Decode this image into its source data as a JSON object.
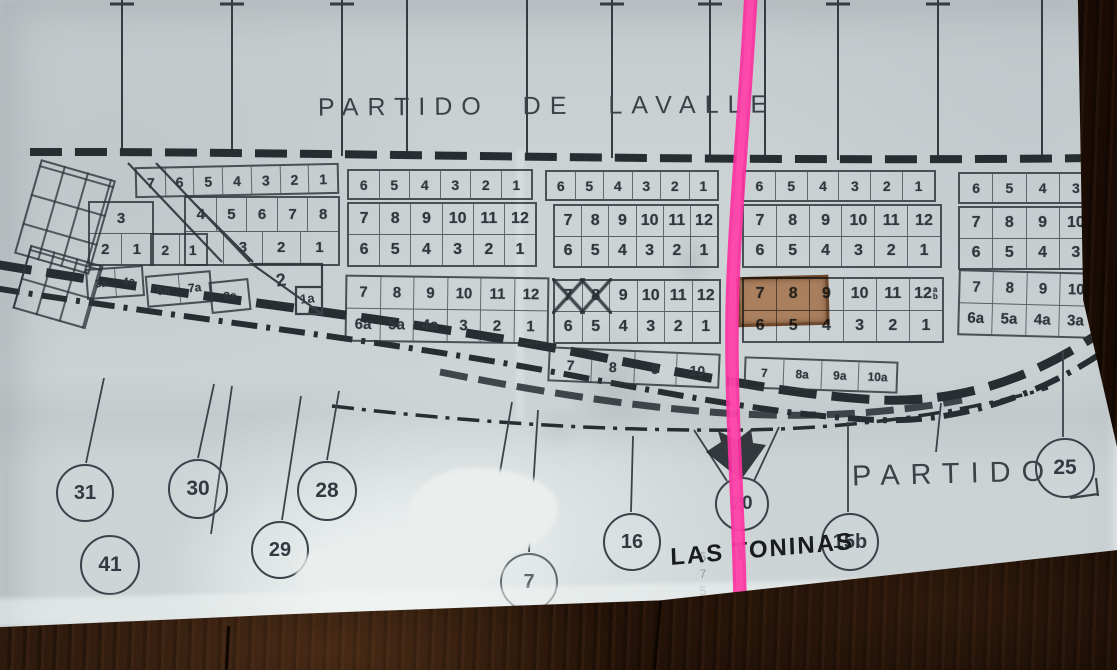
{
  "photo": {
    "title_top": "PARTIDO DE LAVALLE",
    "label_partido_right": "PARTIDO",
    "label_town": "LAS TONINAS",
    "pencil_note": "57528",
    "colors": {
      "paper": "#ccd3d5",
      "ink": "#3a4247",
      "road_ink": "#272d31",
      "pink_marker": "#fb32a0",
      "plot_highlight": "#ba5c18",
      "wood": "#291609"
    },
    "map": {
      "blocks": [
        {
          "id": "a1",
          "x": 135,
          "y": 165,
          "w": 200,
          "h": 27,
          "fs": 14,
          "rot": -1.2,
          "rows": [
            [
              "7",
              "6",
              "5",
              "4",
              "3",
              "2",
              "1"
            ]
          ]
        },
        {
          "id": "a2",
          "x": 347,
          "y": 169,
          "w": 182,
          "h": 27,
          "fs": 14,
          "rows": [
            [
              "6",
              "5",
              "4",
              "3",
              "2",
              "1"
            ]
          ]
        },
        {
          "id": "a3",
          "x": 545,
          "y": 170,
          "w": 170,
          "h": 27,
          "fs": 14,
          "rows": [
            [
              "6",
              "5",
              "4",
              "3",
              "2",
              "1"
            ]
          ]
        },
        {
          "id": "a4",
          "x": 742,
          "y": 170,
          "w": 190,
          "h": 28,
          "fs": 14,
          "rows": [
            [
              "6",
              "5",
              "4",
              "3",
              "2",
              "1"
            ]
          ]
        },
        {
          "id": "a5",
          "x": 958,
          "y": 172,
          "w": 132,
          "h": 28,
          "fs": 14,
          "rows": [
            [
              "6",
              "5",
              "4",
              "3"
            ]
          ]
        },
        {
          "id": "b1a",
          "x": 88,
          "y": 201,
          "w": 62,
          "h": 61,
          "fs": 15,
          "rows": [
            [
              "3"
            ],
            [
              "2",
              "1"
            ]
          ]
        },
        {
          "id": "b1s",
          "x": 150,
          "y": 233,
          "w": 54,
          "h": 29,
          "fs": 14,
          "rows": [
            [
              "2",
              "1"
            ]
          ]
        },
        {
          "id": "b1b",
          "x": 184,
          "y": 196,
          "w": 152,
          "h": 66,
          "fs": 15,
          "rows": [
            [
              "4",
              "5",
              "6",
              "7",
              "8"
            ],
            [
              "",
              "3",
              "2",
              "1"
            ]
          ]
        },
        {
          "id": "b2",
          "x": 347,
          "y": 202,
          "w": 186,
          "h": 61,
          "fs": 16,
          "rows": [
            [
              "7",
              "8",
              "9",
              "10",
              "11",
              "12"
            ],
            [
              "6",
              "5",
              "4",
              "3",
              "2",
              "1"
            ]
          ]
        },
        {
          "id": "b3",
          "x": 553,
          "y": 204,
          "w": 162,
          "h": 60,
          "fs": 16,
          "rows": [
            [
              "7",
              "8",
              "9",
              "10",
              "11",
              "12"
            ],
            [
              "6",
              "5",
              "4",
              "3",
              "2",
              "1"
            ]
          ]
        },
        {
          "id": "b4",
          "x": 742,
          "y": 204,
          "w": 196,
          "h": 60,
          "fs": 16,
          "rows": [
            [
              "7",
              "8",
              "9",
              "10",
              "11",
              "12"
            ],
            [
              "6",
              "5",
              "4",
              "3",
              "2",
              "1"
            ]
          ]
        },
        {
          "id": "b5",
          "x": 958,
          "y": 206,
          "w": 132,
          "h": 60,
          "fs": 16,
          "rows": [
            [
              "7",
              "8",
              "9",
              "10"
            ],
            [
              "6",
              "5",
              "4",
              "3"
            ]
          ]
        },
        {
          "id": "sp1",
          "x": 86,
          "y": 267,
          "w": 54,
          "h": 27,
          "fs": 11,
          "rot": -4,
          "rows": [
            [
              "3a",
              "4a"
            ]
          ]
        },
        {
          "id": "sp2",
          "x": 146,
          "y": 273,
          "w": 62,
          "h": 28,
          "fs": 12,
          "rot": -5,
          "rows": [
            [
              "6a",
              "7a"
            ]
          ]
        },
        {
          "id": "sp3",
          "x": 210,
          "y": 280,
          "w": 36,
          "h": 28,
          "fs": 12,
          "rot": -6,
          "rows": [
            [
              "8a"
            ]
          ]
        },
        {
          "id": "c2",
          "x": 345,
          "y": 276,
          "w": 200,
          "h": 63,
          "fs": 15,
          "rot": 0.8,
          "rows": [
            [
              "7",
              "8",
              "9",
              "10",
              "11",
              "12"
            ],
            [
              "6a",
              "5a",
              "4a",
              "3",
              "2",
              "1"
            ]
          ]
        },
        {
          "id": "c3",
          "x": 553,
          "y": 279,
          "w": 164,
          "h": 61,
          "fs": 16,
          "rows": [
            [
              {
                "l": "7",
                "crossed": true
              },
              {
                "l": "8",
                "crossed": true
              },
              "9",
              "10",
              "11",
              "12"
            ],
            [
              "6",
              "5",
              "4",
              "3",
              "2",
              "1"
            ]
          ]
        },
        {
          "id": "c4",
          "x": 742,
          "y": 277,
          "w": 198,
          "h": 62,
          "fs": 16,
          "rows": [
            [
              "7",
              "8",
              "9",
              "10",
              "11",
              {
                "l": "12",
                "sub": "a/b"
              }
            ],
            [
              "6",
              "5",
              "4",
              "3",
              "2",
              "1"
            ]
          ]
        },
        {
          "id": "c5",
          "x": 958,
          "y": 271,
          "w": 132,
          "h": 62,
          "fs": 15,
          "rot": 1.5,
          "rows": [
            [
              "7",
              "8",
              "9",
              "10"
            ],
            [
              "6a",
              "5a",
              "4a",
              "3a"
            ]
          ]
        },
        {
          "id": "d1",
          "x": 548,
          "y": 350,
          "w": 168,
          "h": 31,
          "fs": 14,
          "rot": 2.5,
          "rows": [
            [
              "7",
              "8",
              "9",
              "10"
            ]
          ]
        },
        {
          "id": "d2",
          "x": 744,
          "y": 359,
          "w": 150,
          "h": 28,
          "fs": 12,
          "rot": 2,
          "rows": [
            [
              "7",
              "8a",
              "9a",
              "10a"
            ]
          ]
        }
      ],
      "loose_labels": [
        {
          "text": "2",
          "x": 276,
          "y": 270,
          "fs": 18,
          "rot": -8
        },
        {
          "text": "1a",
          "x": 300,
          "y": 291,
          "fs": 13,
          "rot": -6
        }
      ],
      "circles": [
        {
          "label": "31",
          "x": 83,
          "y": 491,
          "r": 27
        },
        {
          "label": "30",
          "x": 196,
          "y": 487,
          "r": 28
        },
        {
          "label": "28",
          "x": 325,
          "y": 489,
          "r": 28
        },
        {
          "label": "41",
          "x": 108,
          "y": 563,
          "r": 28
        },
        {
          "label": "29",
          "x": 278,
          "y": 548,
          "r": 27
        },
        {
          "label": "17",
          "x": 497,
          "y": 507,
          "r": 28,
          "fade": 0.8
        },
        {
          "label": "7",
          "x": 527,
          "y": 580,
          "r": 27,
          "fade": 0.75
        },
        {
          "label": "16",
          "x": 630,
          "y": 540,
          "r": 27
        },
        {
          "label": "20",
          "x": 740,
          "y": 502,
          "r": 25
        },
        {
          "label": "15b",
          "x": 848,
          "y": 540,
          "r": 27
        },
        {
          "label": "25",
          "x": 1063,
          "y": 466,
          "r": 28
        }
      ]
    }
  }
}
